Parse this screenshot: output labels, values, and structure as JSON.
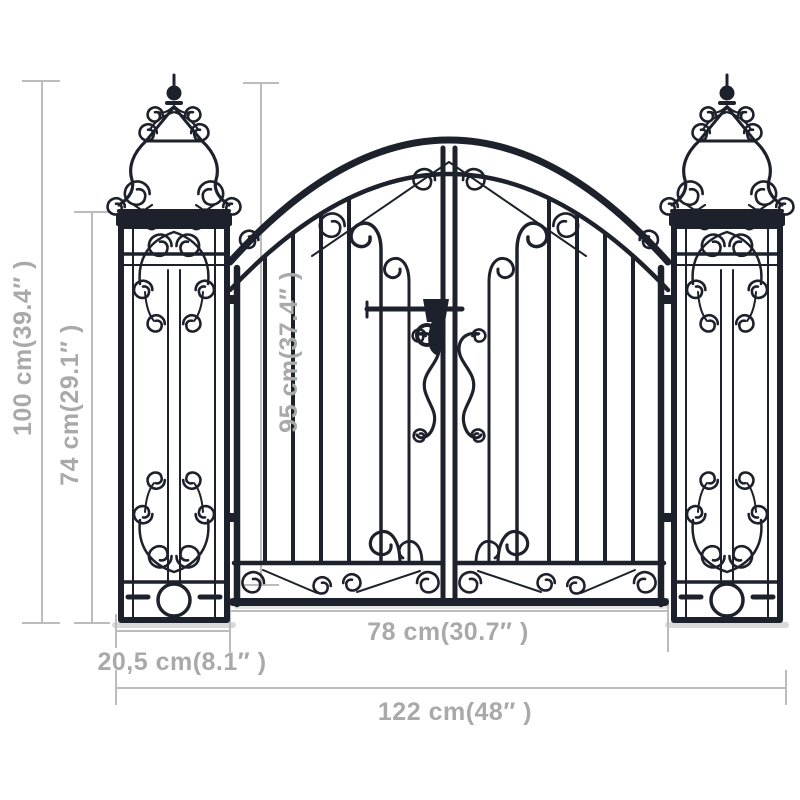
{
  "page": {
    "type": "product-dimension-diagram",
    "product": "ornamental-garden-gate-with-pillars",
    "background": "#ffffff"
  },
  "colors": {
    "iron": "#1d212b",
    "dimension_line": "#bcbcbc",
    "dimension_text": "#a9a9a9",
    "shadow": "#dadada"
  },
  "dimensions": {
    "overall_height": "100 cm(39.4″ )",
    "pillar_height": "74 cm(29.1″ )",
    "gate_leaf_height": "95 cm(37.4″ )",
    "gate_leaf_width": "78 cm(30.7″ )",
    "pillar_width": "20,5 cm(8.1″ )",
    "overall_width": "122 cm(48″ )"
  }
}
